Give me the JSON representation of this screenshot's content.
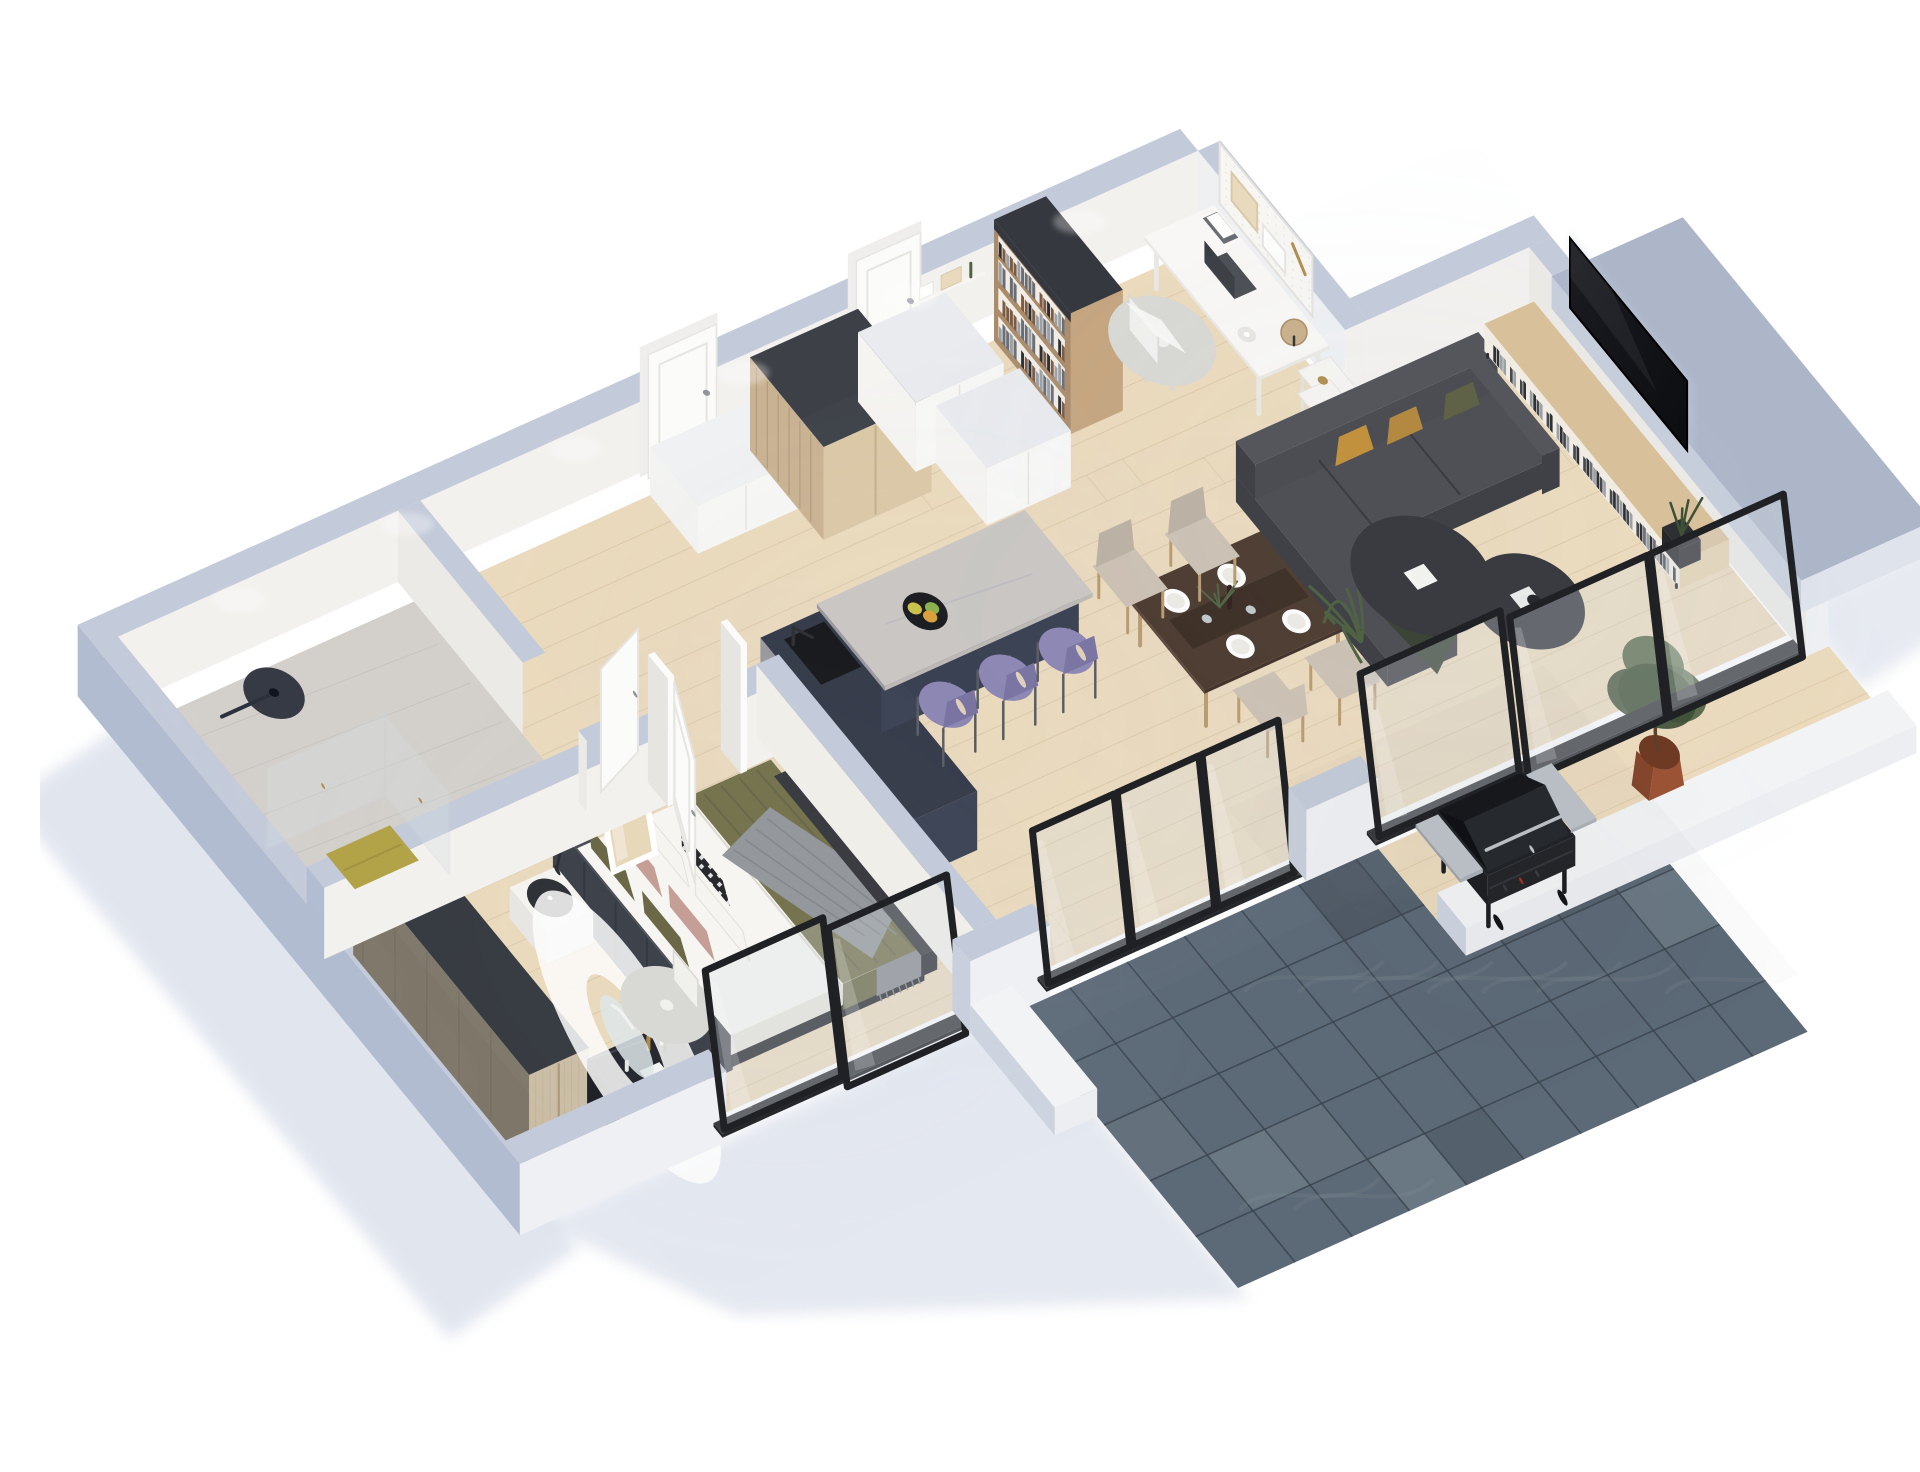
{
  "meta": {
    "type": "3d-isometric-floor-plan-render",
    "caption": "3D isometric floor plan render of a one-bedroom apartment with bathroom, bedroom, hallway, kitchen island, dining area, living room, home office nook and a tiled terrace with barbecue grill",
    "background": "#ffffff"
  },
  "palette": {
    "shadow": "#c5cdde",
    "wallTop": "#c3cad9",
    "wallInner": "#f3f1ee",
    "wallInnerShade": "#eceae6",
    "wallOuterLeft": "#b2bcd1",
    "wallOuterFront": "#eef0f3",
    "wallCapBlue": "#c9cfdc",
    "officeWall": "#eef0f2",
    "floorWood": "#ebdabc",
    "floorWoodLine": "#d6c19e",
    "floorBath": "#d3cfca",
    "floorBathVein": "#c0bcb7",
    "tileBase": "#5c6976",
    "tileDark": "#46515d",
    "tileLine": "#3a434e",
    "tileSwirl": "#93a0ab",
    "rug": "#edebe6",
    "rugBorder": "#dbd8d0",
    "glass": "#d7e0e5",
    "glassHi": "#ffffff",
    "frameBlack": "#1f2124",
    "trackDark": "#26272b",
    "doorWhite": "#fbfbfa",
    "doorShade": "#e6e5e1",
    "doorFrame": "#efeeec",
    "handle": "#8f959b",
    "navyDark": "#333947",
    "navyFace": "#3a4152",
    "marbleGray": "#9b99a0",
    "marbleVein": "#bab8bf",
    "counterMarble": "#c9c6c3",
    "counterEdge": "#bdb9b6",
    "sinkBlack": "#16171a",
    "woodCab": "#c9b291",
    "woodCabSide": "#dbc8a6",
    "woodCabTop": "#3d4147",
    "cabWhite": "#f5f4f1",
    "cabWhiteTop": "#e9ebee",
    "stoolPurple": "#8d87b4",
    "stoolPurpleDk": "#7a74a3",
    "tableWood": "#4a392d",
    "tableWoodSide": "#5a463a",
    "tableRunner": "#3a2c22",
    "chairBeige": "#cbc0b2",
    "chairBeigeDk": "#bbb0a2",
    "legWood": "#b99a6f",
    "sofaBody": "#404146",
    "sofaCushion": "#4f5056",
    "sofaLight": "#55565c",
    "pillowMustard": "#c2913d",
    "pillowOliveSofa": "#5f6246",
    "throwGreen": "#3b4437",
    "ctBlack": "#1a1b1e",
    "ctRim": "#3a3b40",
    "consoleWood": "#d8c09a",
    "consoleSide": "#e6d2af",
    "consoleBg": "#f1ece3",
    "recordDark": "#2e3034",
    "tvBlack": "#0c0d10",
    "plantGreen": "#4f6344",
    "plantGreenDk": "#3e5036",
    "plantGreenLt": "#62754a",
    "potTerra": "#9a5335",
    "potTerraDk": "#83462c",
    "potBlack": "#2e2f33",
    "bedHead": "#3e424a",
    "bedHeadTop": "#4a4e57",
    "bedFrame": "#2c2e33",
    "linen": "#f6f5f1",
    "linenShade": "#e6e4dd",
    "blanketOlive": "#75744e",
    "blanketOliveDk": "#65644a",
    "throwGray": "#94979b",
    "pillowBlush": "#c59e95",
    "pillowOlive": "#6a6847",
    "pillowWhite": "#f5f4f0",
    "accentDk": "#27292d",
    "wardrobeTop": "#33373d",
    "wardrobeLeft": "#7e7769",
    "wardrobeGrain": "#6f695d",
    "wardrobeFront": "#cbbda4",
    "wardrobeFrontGrain": "#bcab8f",
    "shelfWood": "#ab8c69",
    "shelfSide": "#c5a57f",
    "shelfTopDk": "#35383e",
    "shelfBg": "#f1ede6",
    "bookDark": "#2b2d31",
    "bookMid": "#6a6e74",
    "bookLight": "#9aa0a6",
    "bookBrown": "#7c5a43",
    "deskWhite": "#f8f7f5",
    "deskEdge": "#e9e8e4",
    "chairWhite": "#f0f0ed",
    "chairWhiteEdge": "#d8d8d4",
    "laptopDark": "#3a3d42",
    "laptopBase": "#4a4d52",
    "globeTan": "#c9b08a",
    "pegboard": "#f7f6f3",
    "pegDot": "#e2dfd9",
    "frameWoodLt": "#e9d9bd",
    "grillBlack": "#232529",
    "grillDark": "#17181b",
    "grillLid": "#202328",
    "grillSilver": "#b9bec4",
    "knobRed": "#a33226",
    "matYellow": "#b3a348",
    "platformTop": "#adb6c9",
    "platformLeft": "#c6cddb",
    "platformSide": "#dfe3eb",
    "curbWhite": "#f2f3f5",
    "curbLeft": "#cdd3df",
    "curbFront": "#eceef2",
    "brass": "#b08d4f",
    "clockRing": "#2f3237",
    "lampBlack": "#2c2e31",
    "fruitYellow": "#c9c24a",
    "fruitGreen": "#8db04e",
    "fruitOrange": "#d9a13b",
    "mirrorGlass": "#dfe7e9",
    "mirrorWood": "#e8d8ba",
    "showerHead": "#2c323d",
    "metalLeg": "#595d63",
    "paperWhite": "#fdfdfc"
  },
  "rooms": [
    {
      "id": "bathroom",
      "label": "Bathroom"
    },
    {
      "id": "bedroom",
      "label": "Bedroom"
    },
    {
      "id": "hallway",
      "label": "Hallway"
    },
    {
      "id": "kitchen",
      "label": "Kitchen"
    },
    {
      "id": "dining-area",
      "label": "Dining Area"
    },
    {
      "id": "living-room",
      "label": "Living Room"
    },
    {
      "id": "home-office",
      "label": "Home Office Nook"
    },
    {
      "id": "terrace",
      "label": "Terrace"
    }
  ],
  "furniture_inventory": {
    "bathroom": [
      "glass shower enclosure",
      "rain shower head",
      "yellow bath mat"
    ],
    "bedroom": [
      "double bed with dark headboard",
      "olive and blush pillows",
      "olive blanket",
      "gray throw",
      "dark wood wardrobe",
      "white nightstand with clock",
      "leaning mirror",
      "navy vanity desk",
      "round vanity mirror",
      "white desk chair"
    ],
    "kitchen": [
      "navy island with marble counter",
      "black sink",
      "fruit bowl",
      "3 purple bar stools",
      "tall wood cabinet",
      "white cabinets"
    ],
    "dining-area": [
      "dark wood dining table",
      "4 beige chairs",
      "table setting with plates and wine"
    ],
    "living-room": [
      "charcoal corner sofa",
      "mustard pillows",
      "white rug",
      "2 black round coffee tables",
      "oak media console with records",
      "wall-mounted TV",
      "black vase plant"
    ],
    "home-office": [
      "oak bookshelf with books",
      "white desk",
      "laptop",
      "white swivel chair",
      "pegboard with frames",
      "globe",
      "white trolley cart",
      "wall shelf"
    ],
    "terrace": [
      "dark stone tile floor",
      "black barbecue grill with side shelves",
      "potted tree",
      "glass sliding doors"
    ]
  },
  "view": {
    "projection": "isometric",
    "wall_cut": "dollhouse top-down 3/4 view"
  }
}
